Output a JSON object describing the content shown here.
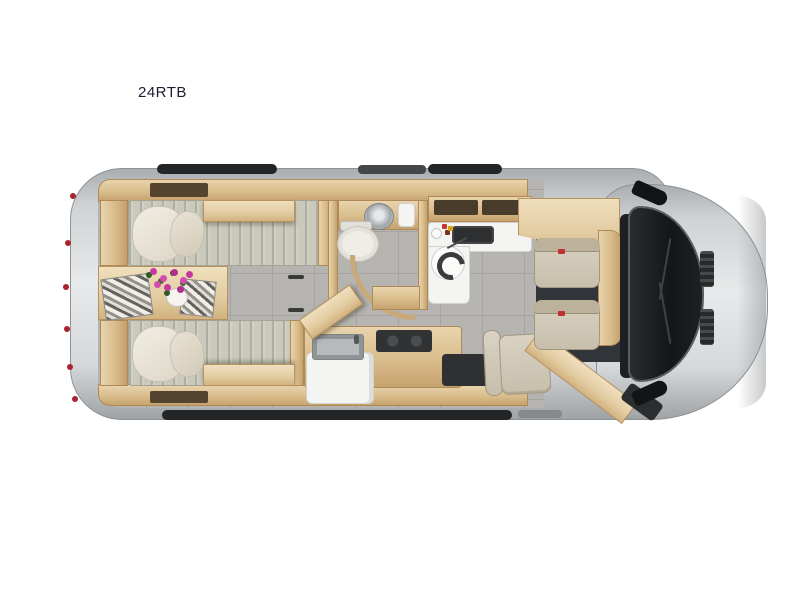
{
  "page": {
    "background": "#ffffff"
  },
  "model": {
    "label": "24RTB",
    "label_color": "#1c1c30"
  },
  "palette": {
    "body_silver": "#d6d9db",
    "roof_trim_dark": "#232527",
    "cabinet_wood": "#d8bc8a",
    "floor_tile_gray": "#b5b4b0",
    "counter_white": "#f4f4f2",
    "mattress_gray_green": "#c9cabc",
    "pillow_cream": "#f2eee4",
    "seat_beige": "#d9d2c2",
    "appliance_dark": "#2a2c2e",
    "flower_magenta": "#c3399e",
    "tail_light_red": "#a8232e"
  },
  "floorplan": {
    "view": "motorhome-top-down-floorplan",
    "areas": [
      "rear-twin-beds",
      "nightstand",
      "bathroom",
      "galley",
      "dinette",
      "cab"
    ],
    "fixtures": [
      "twin-bed",
      "pillow",
      "magazines",
      "flower-bouquet",
      "toilet",
      "corner-sink",
      "curved-shower-door",
      "vanity-counter",
      "swivel-sink-bowl",
      "galley-sink",
      "sink-cover-open",
      "cooktop",
      "refrigerator",
      "entry-step",
      "dinette-chair",
      "driver-seat",
      "passenger-seat",
      "dashboard",
      "windshield",
      "side-mirror",
      "hood",
      "tail-lights"
    ]
  }
}
